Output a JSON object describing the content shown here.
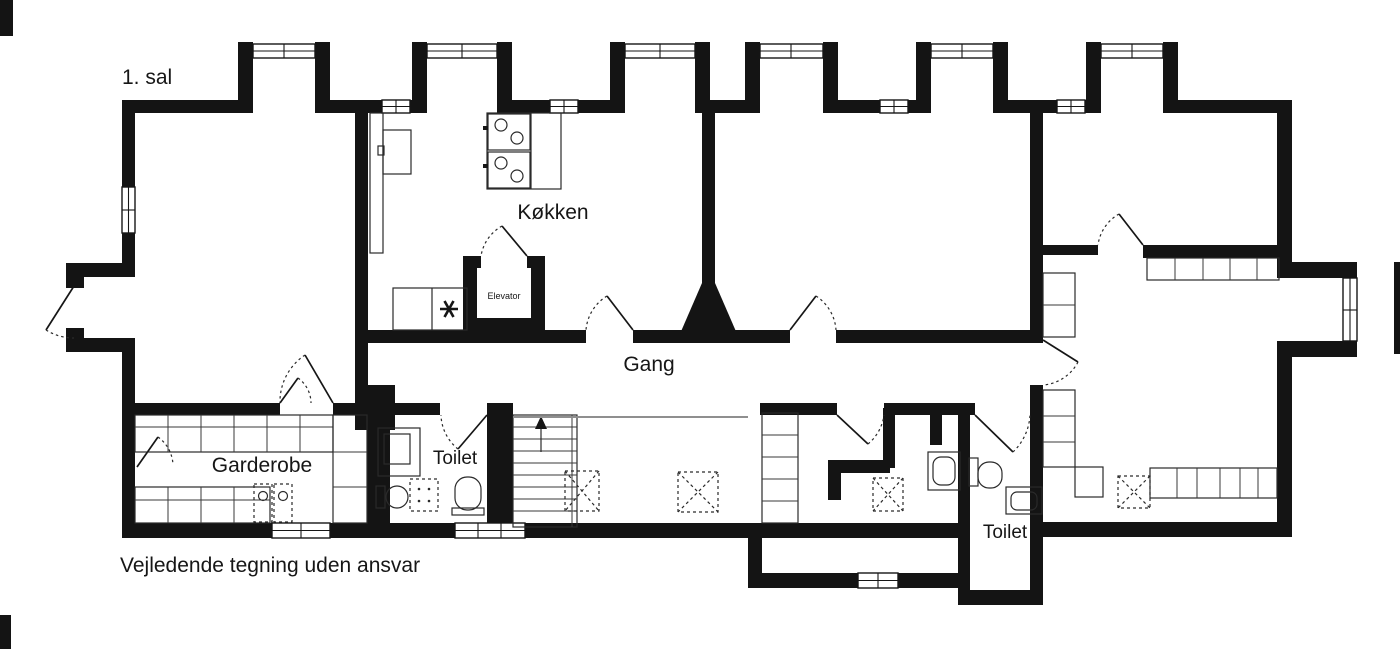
{
  "floorplan": {
    "floor_label": "1. sal",
    "disclaimer": "Vejledende tegning uden ansvar",
    "rooms": {
      "kitchen": {
        "label": "Køkken"
      },
      "hallway": {
        "label": "Gang"
      },
      "wardrobe": {
        "label": "Garderobe"
      },
      "toilet_left": {
        "label": "Toilet"
      },
      "toilet_right": {
        "label": "Toilet"
      },
      "elevator": {
        "label": "Elevator"
      }
    },
    "colors": {
      "wall": "#141414",
      "background": "#ffffff",
      "guide_line": "#8f8f8f"
    },
    "icons": {
      "stove": "stove-4-burner-icon",
      "stairs": "stairs-up-arrow-icon",
      "skylight": "skylight-dashed-icon",
      "drain": "asterisk-drain-icon",
      "door": "door-swing-arc-icon",
      "window": "double-line-window-icon",
      "wc": "toilet-bowl-icon",
      "sink": "sink-icon"
    }
  }
}
